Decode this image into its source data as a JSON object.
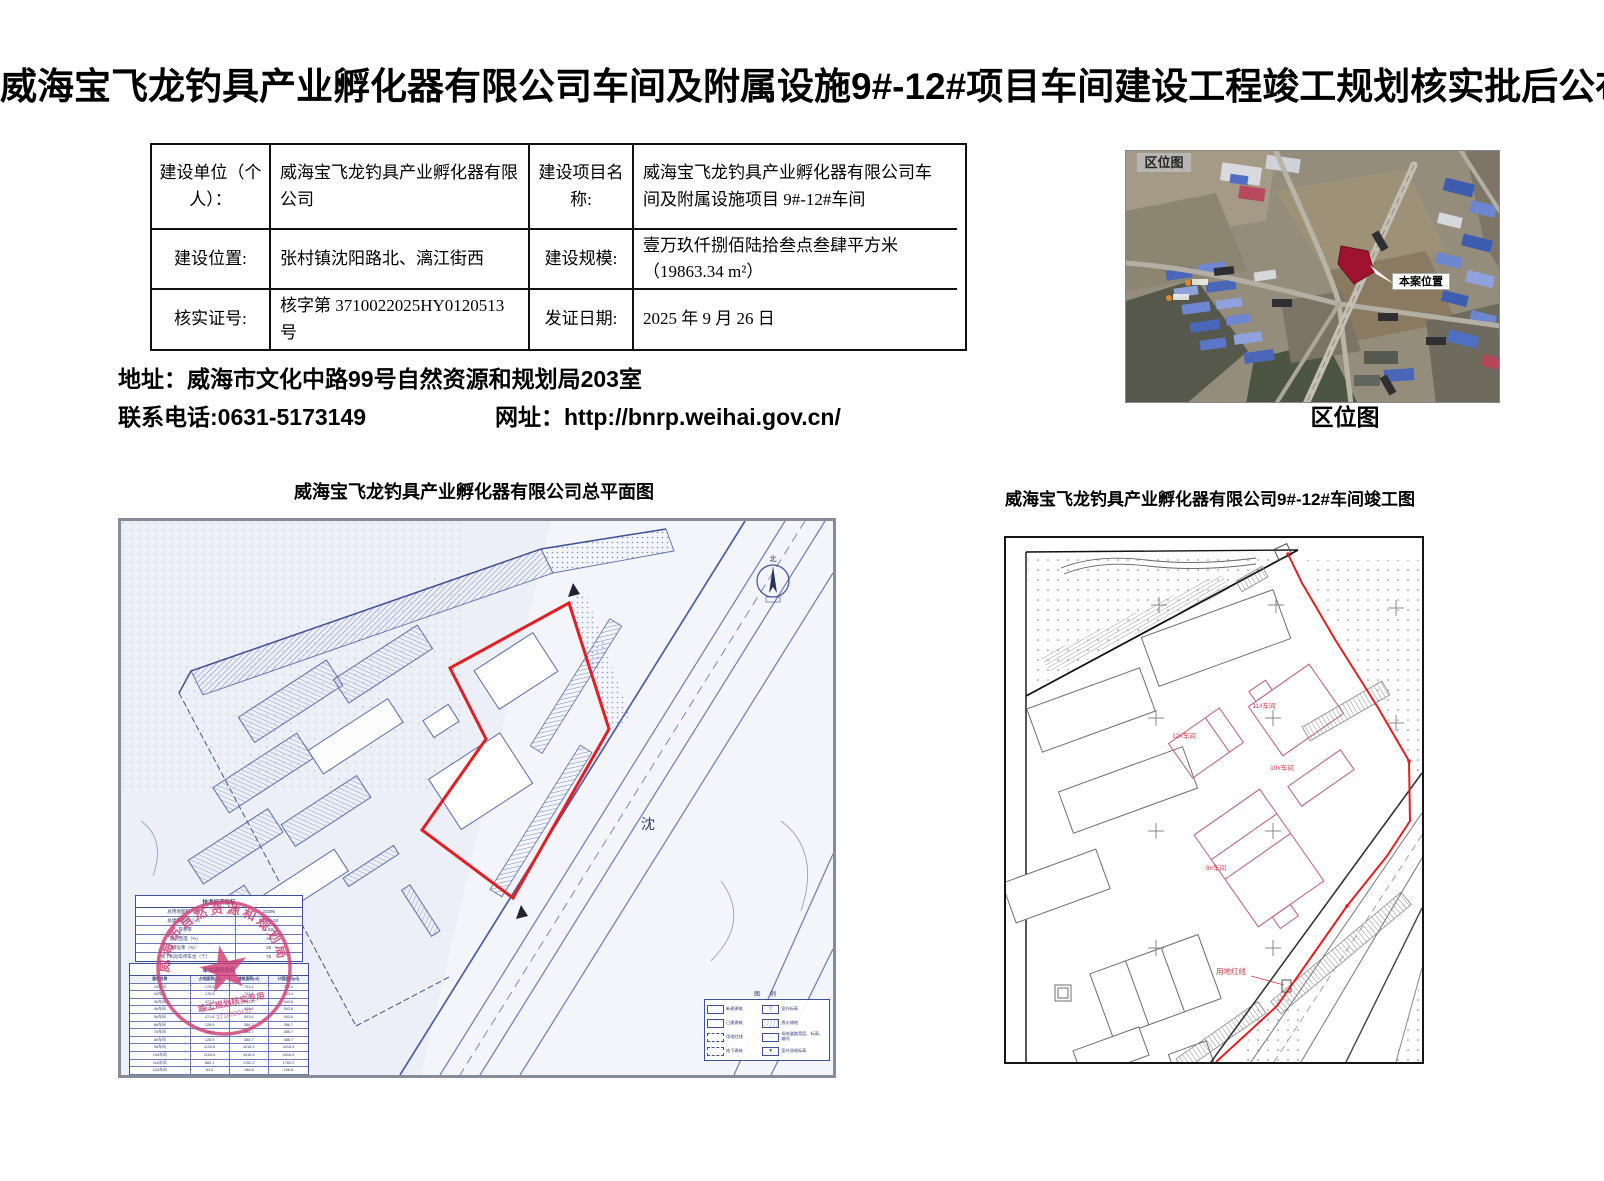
{
  "page_title": "威海宝飞龙钓具产业孵化器有限公司车间及附属设施9#-12#项目车间建设工程竣工规划核实批后公布",
  "info_table": {
    "rows": [
      {
        "l1": "建设单位（个人）：",
        "v1": "威海宝飞龙钓具产业孵化器有限公司",
        "l2": "建设项目名称:",
        "v2": "威海宝飞龙钓具产业孵化器有限公司车间及附属设施项目 9#-12#车间"
      },
      {
        "l1": "建设位置:",
        "v1": "张村镇沈阳路北、漓江街西",
        "l2": "建设规模:",
        "v2": "壹万玖仟捌佰陆拾叁点叁肆平方米（19863.34 m²）"
      },
      {
        "l1": "核实证号:",
        "v1": "核字第 3710022025HY0120513 号",
        "l2": "发证日期:",
        "v2": "2025 年 9 月 26 日"
      }
    ]
  },
  "contact": {
    "address": "地址：威海市文化中路99号自然资源和规划局203室",
    "phone": "联系电话:0631-5173149",
    "website": "网址：http://bnrp.weihai.gov.cn/"
  },
  "location_map": {
    "corner_label": "区位图",
    "marker_label": "本案位置",
    "caption": "区位图",
    "marker_color": "#9e1330"
  },
  "site_plan": {
    "title": "威海宝飞龙钓具产业孵化器有限公司总平面图",
    "compass_label": "北",
    "road_labels": [
      "沈",
      "阳"
    ],
    "legend": {
      "title": "图 例",
      "items_left": [
        "新建建筑",
        "已建建筑",
        "用地红线",
        "地下建筑"
      ],
      "items_right": [
        "室外标高",
        "透水铺地",
        "场地道路宽度、标高、坡向",
        "室外场地标高"
      ]
    },
    "tech_table": {
      "title": "技术经济指标",
      "rows": [
        [
          "总用地面积（㎡）",
          "33396"
        ],
        [
          "总建筑面积（㎡）",
          "63594.92"
        ],
        [
          "容积率",
          "1.92"
        ],
        [
          "建筑密度（%）",
          "43"
        ],
        [
          "绿化率（%）",
          "25"
        ],
        [
          "地下机动车停车位（个）",
          "75"
        ]
      ]
    },
    "unit_table": {
      "title": "单体建筑指标",
      "headers": [
        "建筑名称",
        "占地面积(㎡)",
        "建筑面积(㎡)",
        "计容面积(㎡)"
      ],
      "rows": [
        [
          "1#车间",
          "176.5",
          "703.4",
          "703.4"
        ],
        [
          "2#车间",
          "176.5",
          "703.4",
          "703.4"
        ],
        [
          "3#车间",
          "471.8",
          "943.6",
          "943.6"
        ],
        [
          "4#车间",
          "471.8",
          "943.6",
          "943.6"
        ],
        [
          "5#车间",
          "471.8",
          "943.6",
          "943.6"
        ],
        [
          "6#车间",
          "128.9",
          "386.7",
          "386.7"
        ],
        [
          "7#车间",
          "128.9",
          "386.7",
          "386.7"
        ],
        [
          "8#车间",
          "128.9",
          "386.7",
          "386.7"
        ],
        [
          "9#车间",
          "1104.6",
          "4418.4",
          "4418.4"
        ],
        [
          "10#车间",
          "1104.6",
          "4418.4",
          "4418.4"
        ],
        [
          "11#车间",
          "880.1",
          "1760.2",
          "1760.2"
        ],
        [
          "12#车间",
          "83.4",
          "166.8",
          "166.8"
        ],
        [
          "合计",
          "—",
          "19863.34",
          "19863.34"
        ]
      ]
    },
    "stamp": {
      "agency": "威海市自然资源和规划局",
      "banner": "竣工规划核实专用",
      "number": "3710020132"
    }
  },
  "completion_plan": {
    "title": "威海宝飞龙钓具产业孵化器有限公司9#-12#车间竣工图",
    "buildings": [
      "12#车间",
      "11#车间",
      "10#车间",
      "9#车间"
    ],
    "redline_label": "用地红线"
  }
}
